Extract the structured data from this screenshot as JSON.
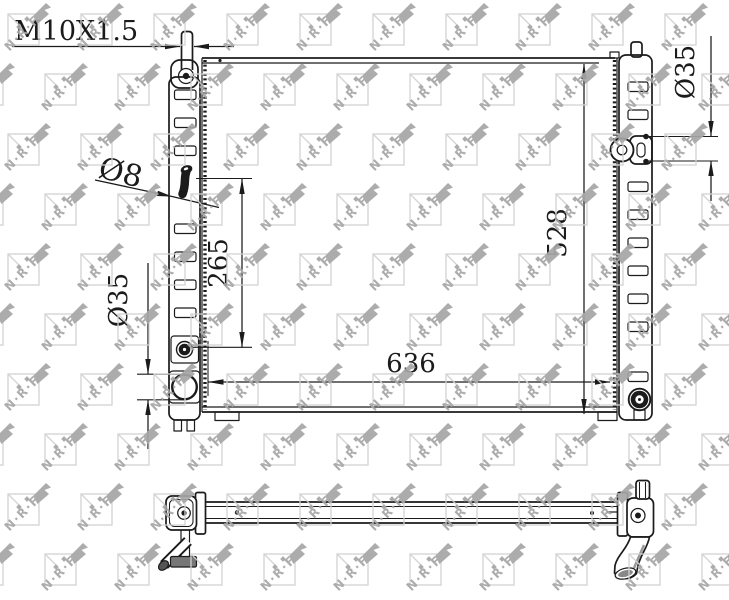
{
  "labels": {
    "thread": "M10X1.5",
    "small_pipe_diameter": "Ø8",
    "left_port_diameter": "Ø35",
    "right_port_diameter": "Ø35",
    "port_vertical_spacing": "265",
    "core_width": "636",
    "core_height": "528"
  },
  "watermark": {
    "text": "N·R·F"
  },
  "colors": {
    "line": "#1b1b1b",
    "wm_light": "#d2d2d2",
    "wm_dark": "#a6a6a6",
    "background": "#ffffff"
  }
}
